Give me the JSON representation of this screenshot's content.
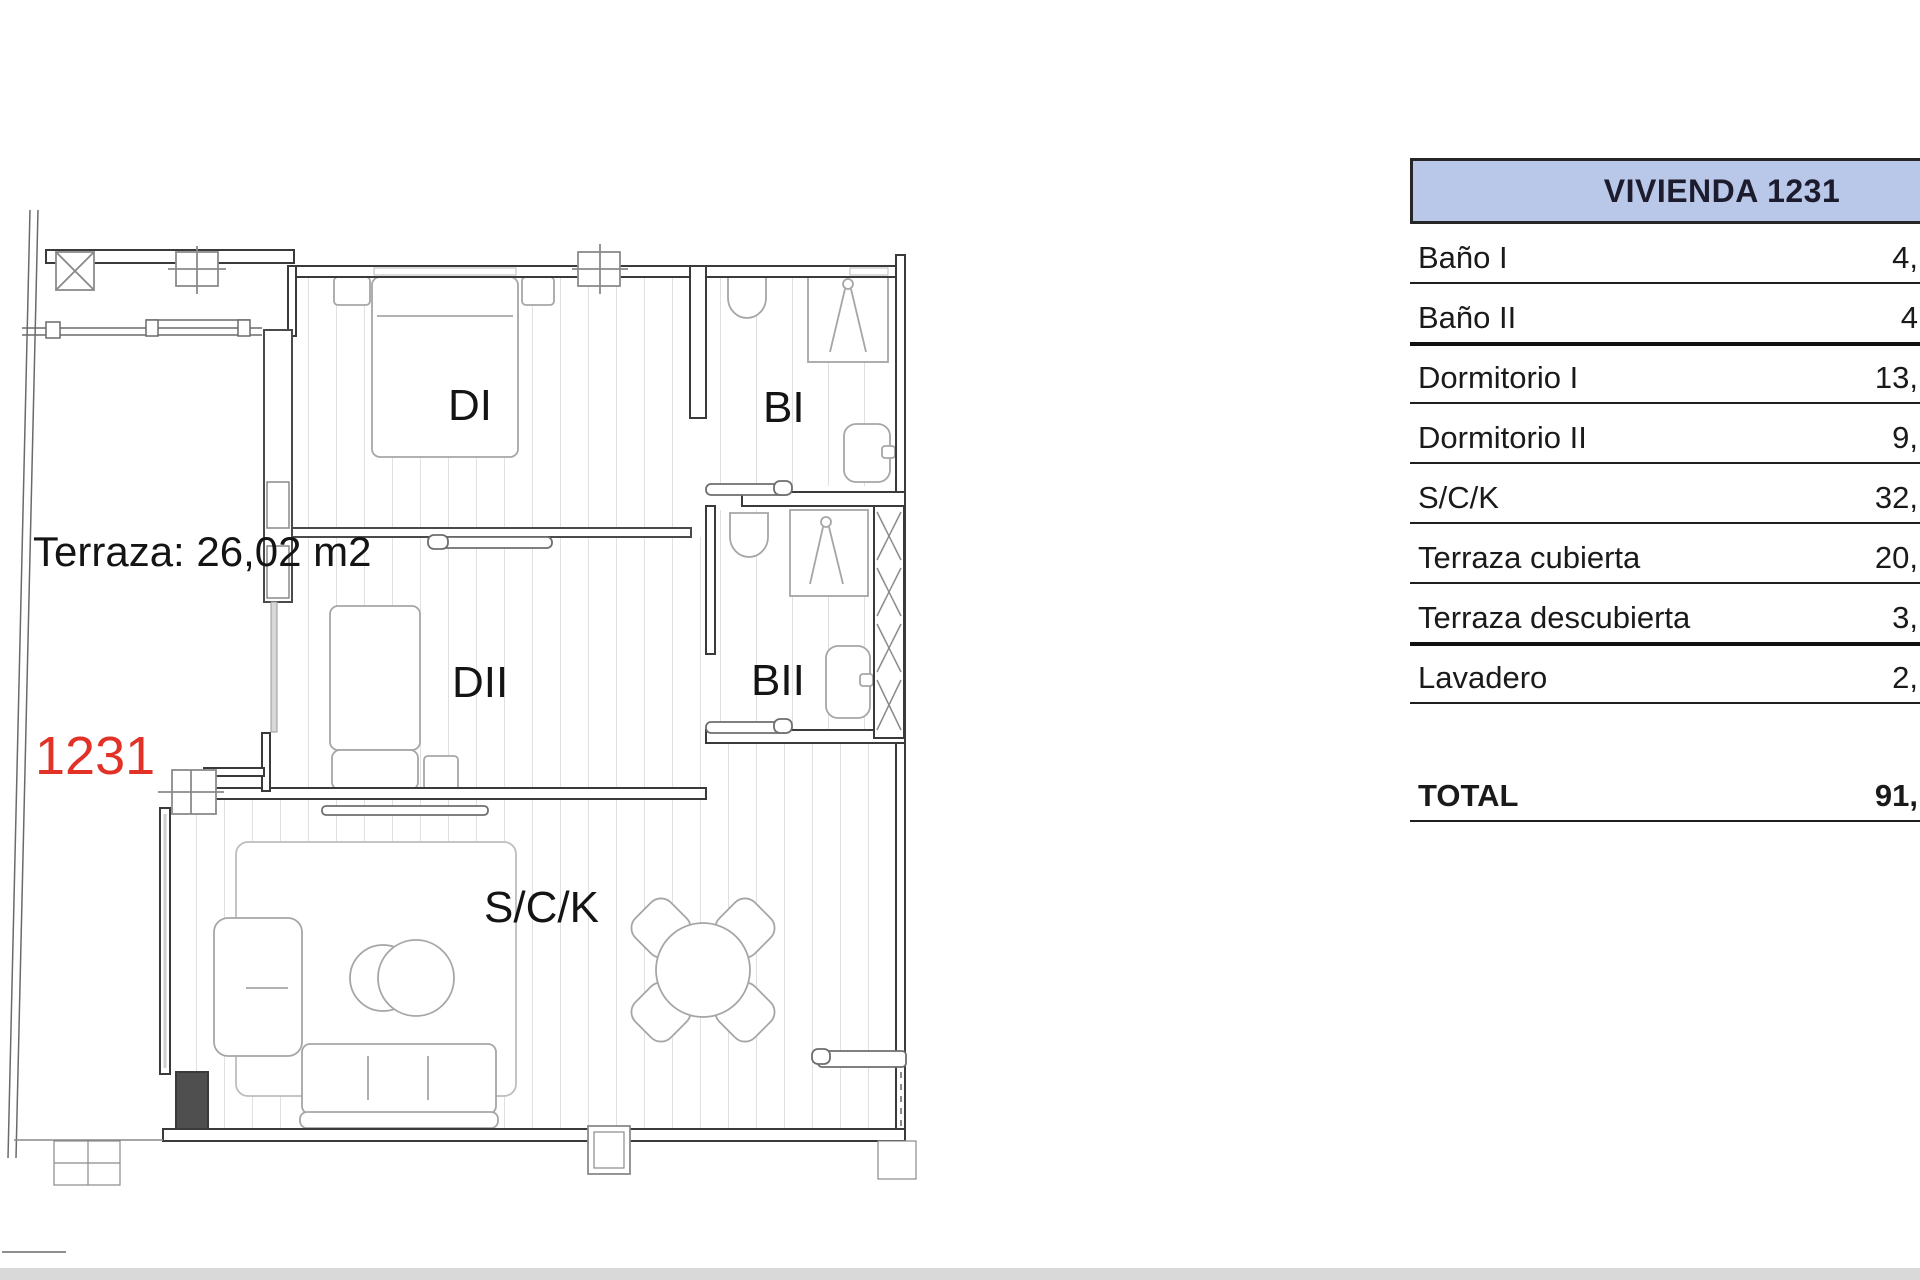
{
  "floorplan": {
    "labels": {
      "bedroom1": "DI",
      "bathroom1": "BI",
      "bedroom2": "DII",
      "bathroom2": "BII",
      "living_kitchen": "S/C/K",
      "terrace_area": "Terraza: 26,02 m2",
      "unit_number": "1231"
    },
    "colors": {
      "unit_number_red": "#e23127",
      "wall_line": "#3a3a3a",
      "floor_line": "#cccccc"
    }
  },
  "area_table": {
    "header": "VIVIENDA 1231",
    "header_fill": "#b9c7e8",
    "rows": [
      {
        "label": "Baño I",
        "value": "4,"
      },
      {
        "label": "Baño II",
        "value": "4"
      },
      {
        "label": "Dormitorio I",
        "value": "13,"
      },
      {
        "label": "Dormitorio II",
        "value": "9,"
      },
      {
        "label": "S/C/K",
        "value": "32,"
      },
      {
        "label": "Terraza cubierta",
        "value": "20,"
      },
      {
        "label": "Terraza descubierta",
        "value": "3,"
      },
      {
        "label": "Lavadero",
        "value": "2,"
      }
    ],
    "total": {
      "label": "TOTAL",
      "value": "91,"
    }
  }
}
